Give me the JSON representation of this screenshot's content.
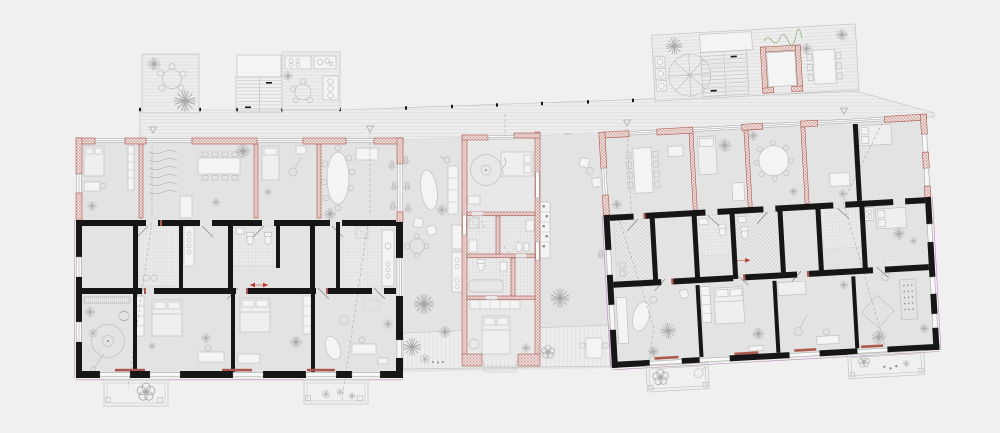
{
  "canvas": {
    "width": 1000,
    "height": 433
  },
  "colors": {
    "bg": "#f0f0f0",
    "floor": "#e3e3e3",
    "floorLight": "#e8e8e8",
    "deckBg": "#ededed",
    "deckLine": "#d6d6d6",
    "wallBlack": "#161616",
    "wallRed": "#ad584f",
    "wallRedFill": "#f4ebe9",
    "tileBg": "#eaeaea",
    "tileLine": "#c9c9c9",
    "tileLineX": "#b6b6b6",
    "line": "#bdbdbd",
    "lineDark": "#8f8f8f",
    "furnFill": "#efefef",
    "furnStroke": "#c0c0c0",
    "plant": "#a9a9a9",
    "plantGreen": "#9cb890",
    "accentRed": "#c0392b",
    "purple": "#a974a9",
    "dash": "#9c9c9c"
  },
  "features": {
    "decks": [
      "roof-terrace-left",
      "roof-terrace-right",
      "connecting-walkway",
      "garden-deck"
    ],
    "circulation": [
      "staircase-left",
      "staircase-right",
      "parasol-table",
      "elevator-shaft",
      "entry-markers"
    ],
    "buildings": [
      "left-apartment-block",
      "central-core",
      "right-apartment-block"
    ],
    "outdoor": [
      "courtyard-garden",
      "balconies",
      "planters",
      "plants",
      "outdoor-kitchen"
    ],
    "rooms": [
      "living-dining-rooms",
      "bedrooms",
      "bathrooms",
      "kitchens",
      "corridors"
    ]
  }
}
